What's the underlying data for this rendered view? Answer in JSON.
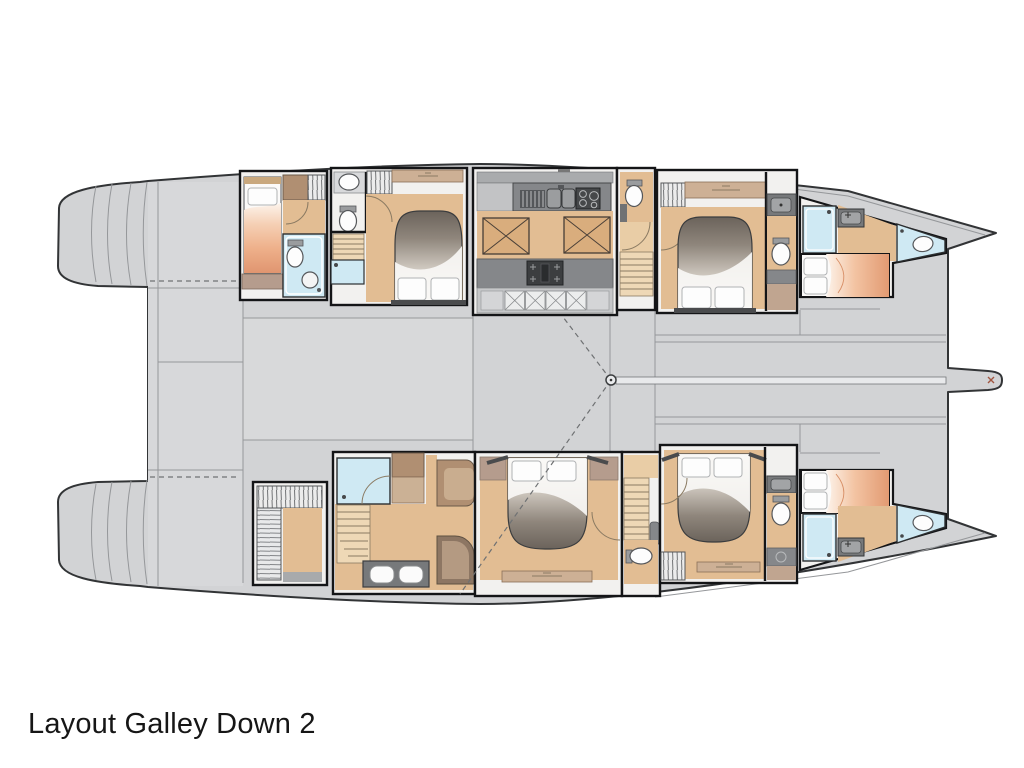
{
  "title": "Layout Galley Down 2",
  "plan": {
    "type": "catamaran yacht lower-deck floor plan",
    "orientation": "bow-right",
    "center_features": [
      "aft-cockpit",
      "twin-transom-step-platforms",
      "saloon-sole-panel",
      "mast-step-point",
      "rigging-sight-lines",
      "foredeck-centerline",
      "bowsprit"
    ],
    "port_hull_rooms": [
      {
        "room": "aft-guest-cabin",
        "fixtures": [
          "single-berth",
          "wardrobe",
          "hanging-locker",
          "shower-room",
          "toilet",
          "washbasin"
        ]
      },
      {
        "room": "mid-aft-guest-cabin",
        "fixtures": [
          "double-berth",
          "washbasin",
          "toilet",
          "hanging-locker",
          "staircase",
          "shower"
        ]
      },
      {
        "room": "galley-down",
        "fixtures": [
          "drainer",
          "double-sink",
          "stove",
          "hob",
          "floor-hatches",
          "storage-lockers"
        ]
      },
      {
        "room": "day-head-companionway",
        "fixtures": [
          "toilet",
          "staircase"
        ]
      },
      {
        "room": "forward-guest-cabin",
        "fixtures": [
          "double-berth",
          "hanging-locker",
          "washbasin",
          "toilet"
        ]
      },
      {
        "room": "forepeak-crew-cabin",
        "fixtures": [
          "berth",
          "shower",
          "washbasin",
          "sea-toilet"
        ]
      }
    ],
    "starboard_hull_rooms": [
      {
        "room": "aft-wardrobe",
        "fixtures": [
          "hanging-locker",
          "shelving"
        ]
      },
      {
        "room": "owner-bathroom",
        "fixtures": [
          "shower-room",
          "cabinet",
          "desk",
          "staircase",
          "seat",
          "twin-sink-vanity"
        ]
      },
      {
        "room": "owner-cabin",
        "fixtures": [
          "double-berth",
          "shelf-band",
          "door"
        ]
      },
      {
        "room": "day-head-companionway",
        "fixtures": [
          "staircase",
          "washbasin",
          "toilet"
        ]
      },
      {
        "room": "mid-guest-cabin",
        "fixtures": [
          "double-berth",
          "wardrobe",
          "washbasin",
          "toilet",
          "shower"
        ]
      },
      {
        "room": "forepeak-crew-cabin",
        "fixtures": [
          "berth",
          "shower",
          "washbasin",
          "sea-toilet"
        ]
      }
    ],
    "colors": {
      "background": "#ffffff",
      "deck": "#d2d3d5",
      "deck_light": "#d9dadc",
      "floor_wood": "#e2bd93",
      "floor_light": "#eed8b6",
      "hatch_wood": "#d9ad7d",
      "cabinet_wood": "#b08f72",
      "shelf_wood": "#cdb095",
      "upholstery": "#b59c8d",
      "counter_gray": "#77797b",
      "appliance_gray": "#46484a",
      "shower_blue": "#cfe9f3",
      "blanket_gray": "#6b635b",
      "blanket_peach": "#e29a72",
      "wall_line": "#141517",
      "text": "#161616"
    }
  }
}
